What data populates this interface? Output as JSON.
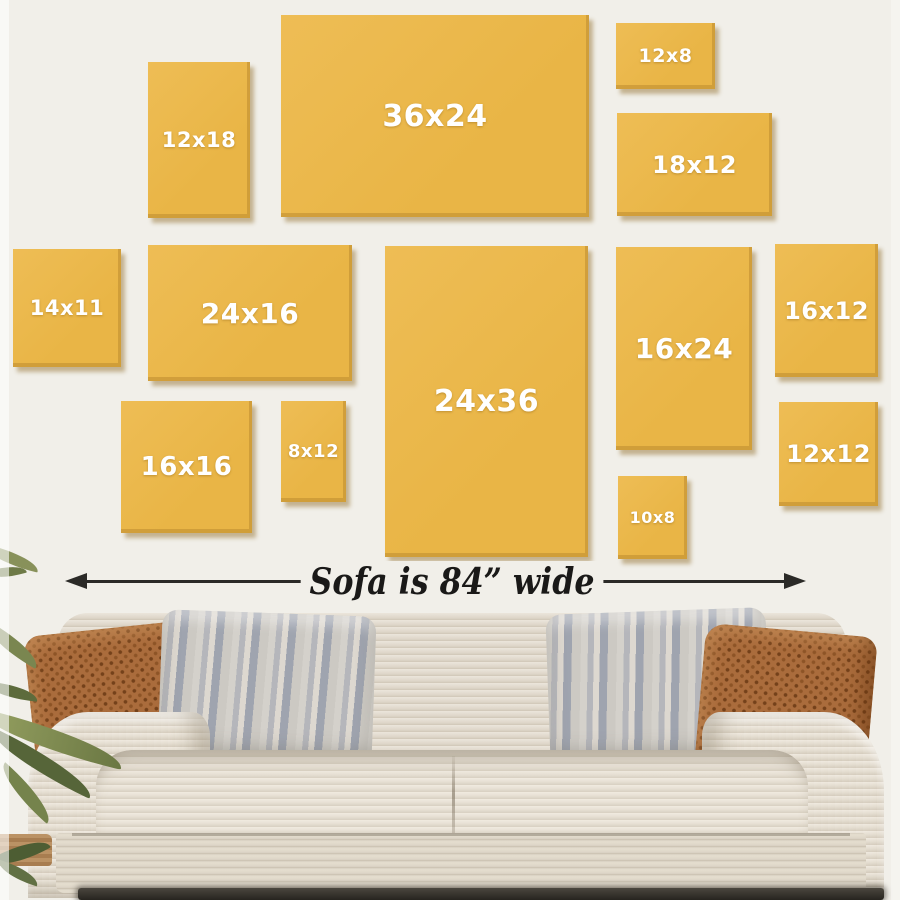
{
  "title": "Wall art size guide above a sofa",
  "colors": {
    "wall": "#f1efe9",
    "frame_fill": "#e9b546",
    "frame_fill_light": "#eebd55",
    "frame_text": "#ffffff",
    "arrow": "#2b2a27",
    "caption_text": "#1a1918"
  },
  "frames": [
    {
      "label": "12x18",
      "x": 148,
      "y": 62,
      "w": 102,
      "h": 156,
      "font": 21
    },
    {
      "label": "36x24",
      "x": 281,
      "y": 15,
      "w": 308,
      "h": 202,
      "font": 30
    },
    {
      "label": "12x8",
      "x": 616,
      "y": 23,
      "w": 99,
      "h": 66,
      "font": 19
    },
    {
      "label": "18x12",
      "x": 617,
      "y": 113,
      "w": 155,
      "h": 103,
      "font": 24
    },
    {
      "label": "14x11",
      "x": 13,
      "y": 249,
      "w": 108,
      "h": 118,
      "font": 21
    },
    {
      "label": "24x16",
      "x": 148,
      "y": 245,
      "w": 204,
      "h": 136,
      "font": 28
    },
    {
      "label": "24x36",
      "x": 385,
      "y": 246,
      "w": 203,
      "h": 311,
      "font": 30
    },
    {
      "label": "16x24",
      "x": 616,
      "y": 247,
      "w": 136,
      "h": 203,
      "font": 28
    },
    {
      "label": "16x12",
      "x": 775,
      "y": 244,
      "w": 103,
      "h": 133,
      "font": 24
    },
    {
      "label": "16x16",
      "x": 121,
      "y": 401,
      "w": 131,
      "h": 132,
      "font": 26
    },
    {
      "label": "8x12",
      "x": 281,
      "y": 401,
      "w": 65,
      "h": 101,
      "font": 18
    },
    {
      "label": "10x8",
      "x": 618,
      "y": 476,
      "w": 69,
      "h": 83,
      "font": 16
    },
    {
      "label": "12x12",
      "x": 779,
      "y": 402,
      "w": 99,
      "h": 104,
      "font": 24
    }
  ],
  "ruler": {
    "label": "Sofa is 84” wide",
    "x_start": 65,
    "x_end": 806,
    "y": 581,
    "label_center_x": 452
  }
}
